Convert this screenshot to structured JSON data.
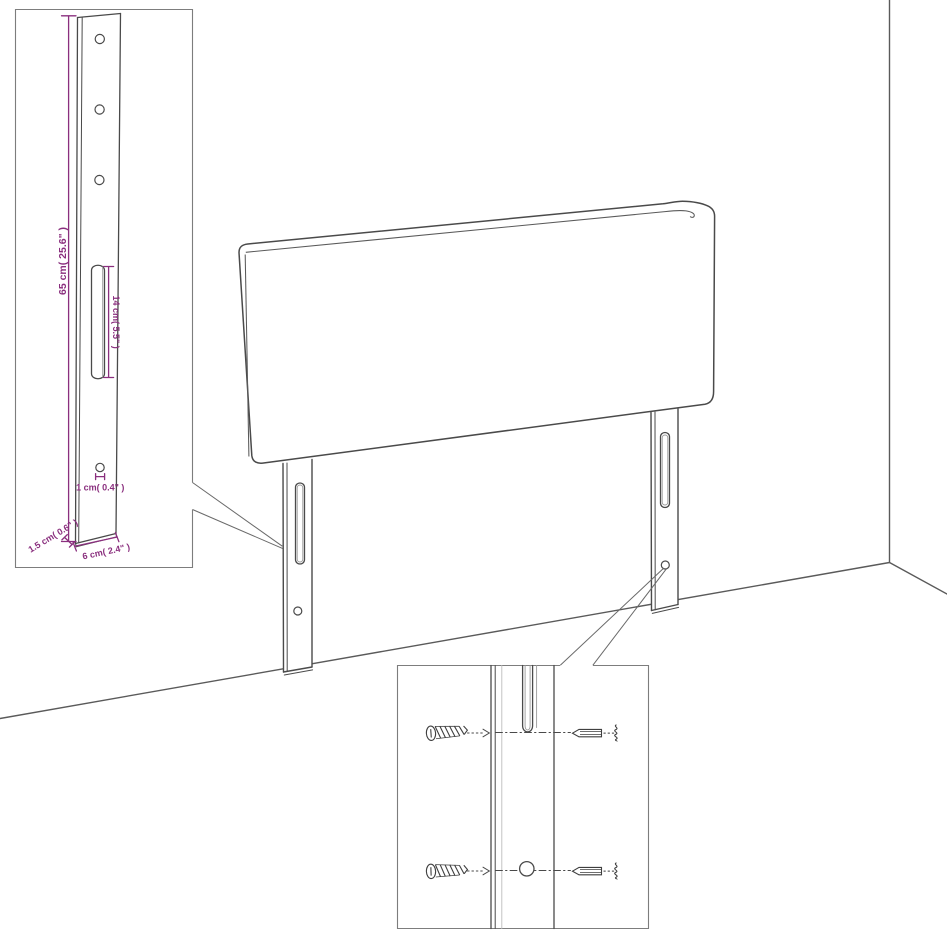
{
  "diagram": {
    "title": "Headboard dimension and wall-mounting diagram",
    "colors": {
      "line": "#4a4a4a",
      "accent": "#8a2f7e",
      "background": "#ffffff",
      "inset_border": "#7d7d7d"
    },
    "labels": {
      "height": "65 cm( 25.6\" )",
      "slot_length": "14 cm( 5.5\" )",
      "hole_diameter": "1 cm( 0.4\" )",
      "thickness": "1.5 cm( 0.6\" )",
      "width": "6 cm( 2.4\" )"
    },
    "icons": {
      "screw": "screw-icon",
      "wall_plug": "wall-plug-icon"
    }
  }
}
